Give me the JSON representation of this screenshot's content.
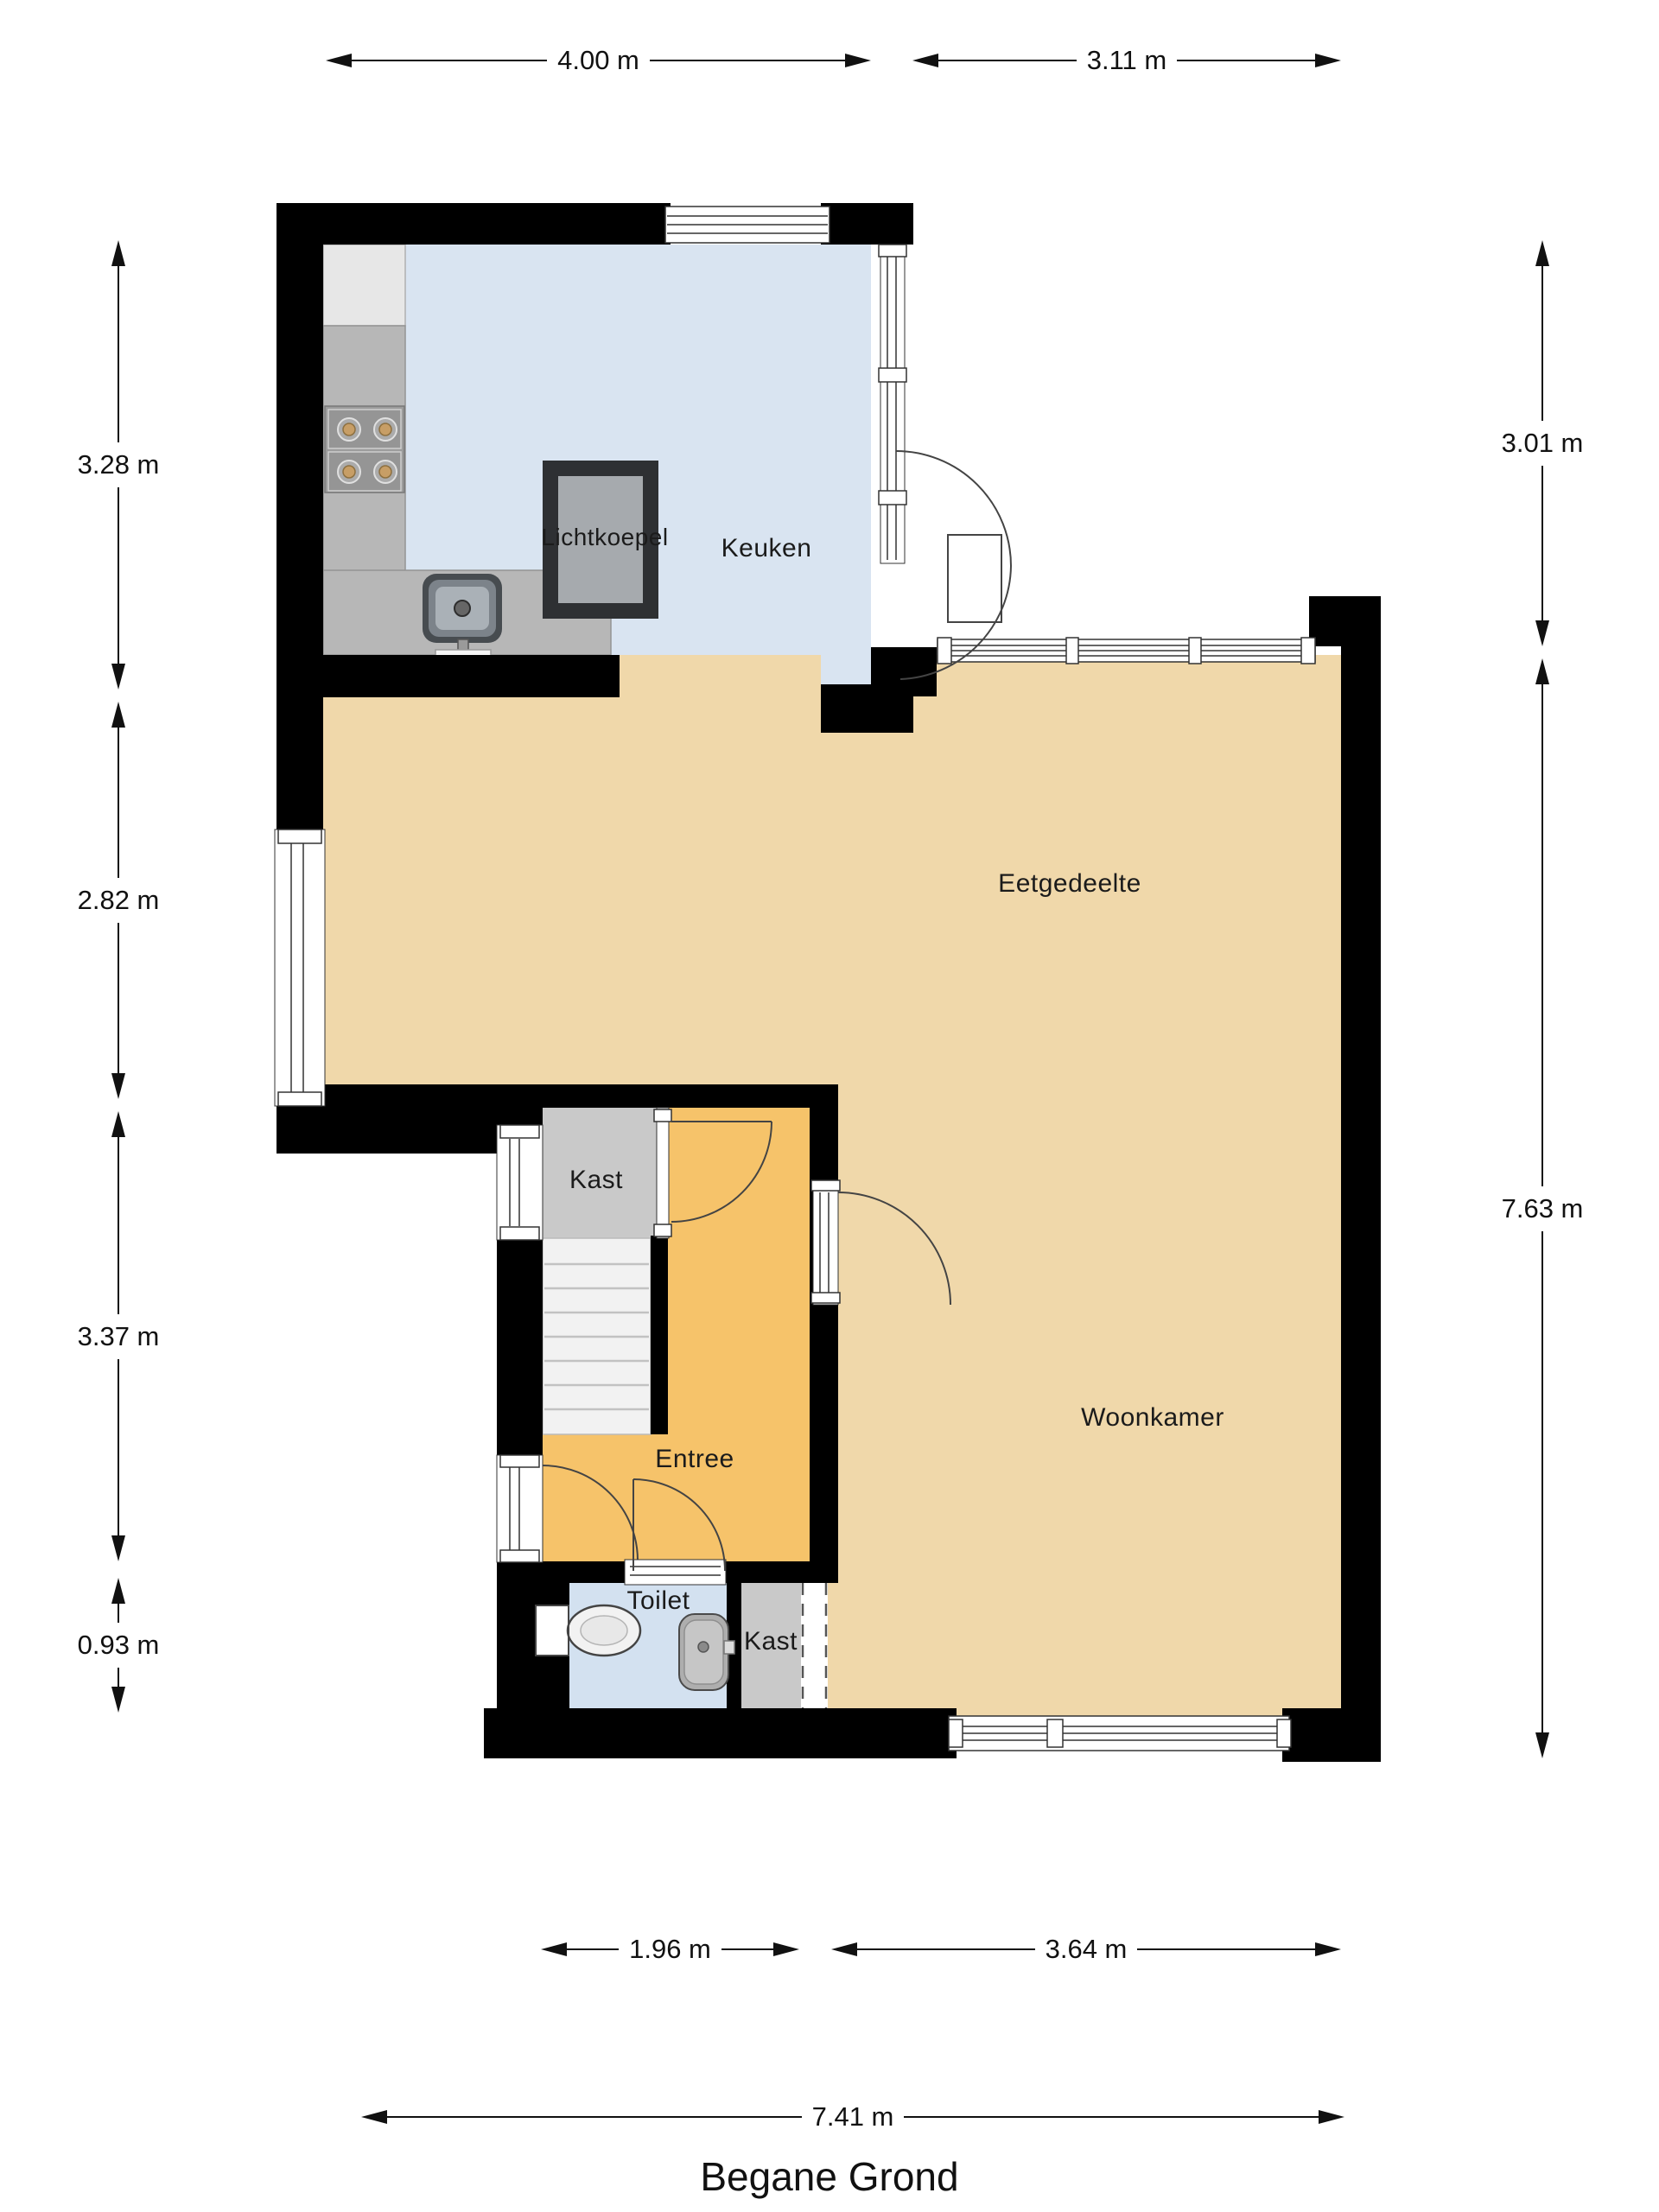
{
  "title": {
    "label": "Begane Grond"
  },
  "rooms": {
    "keuken": {
      "label": "Keuken"
    },
    "lichtkoepel": {
      "label": "Lichtkoepel"
    },
    "eetgedeelte": {
      "label": "Eetgedeelte"
    },
    "kast_hal": {
      "label": "Kast"
    },
    "entree": {
      "label": "Entree"
    },
    "woonkamer": {
      "label": "Woonkamer"
    },
    "toilet": {
      "label": "Toilet"
    },
    "kast_woonkamer": {
      "label": "Kast"
    }
  },
  "dimensions": {
    "top": [
      {
        "label": "4.00 m"
      },
      {
        "label": "3.11 m"
      }
    ],
    "left": [
      {
        "label": "3.28 m"
      },
      {
        "label": "2.82 m"
      },
      {
        "label": "3.37 m"
      },
      {
        "label": "0.93 m"
      }
    ],
    "right": [
      {
        "label": "3.01 m"
      },
      {
        "label": "7.63 m"
      }
    ],
    "bottom": [
      {
        "label": "1.96 m"
      },
      {
        "label": "3.64 m"
      }
    ],
    "overall": {
      "label": "7.41 m"
    }
  },
  "colors": {
    "wall": "#000000",
    "kitchen_floor": "#d9e4f1",
    "dining_living_floor": "#f0d8aa",
    "entry_floor": "#f6c36a",
    "toilet_floor": "#d3e1f0",
    "closet_floor": "#c9c9c9",
    "counter": "#b7b7b7",
    "stairs": "#f2f2f2",
    "skylight_frame": "#2e3033",
    "skylight_glass": "#a6aaae"
  }
}
